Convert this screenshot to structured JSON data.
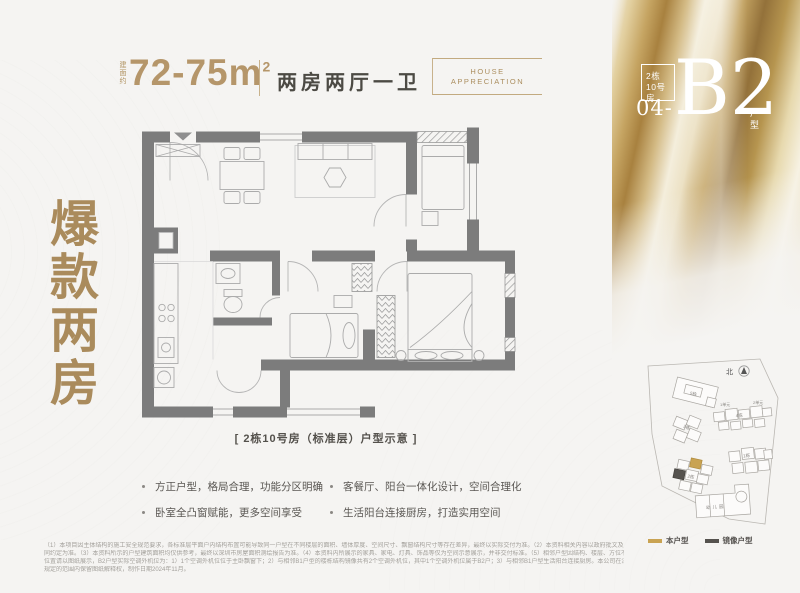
{
  "colors": {
    "page_bg": "#f5f4f2",
    "gold_text": "#aa8b5c",
    "gold_accent": "#c9a352",
    "dark_text": "#4c4a46",
    "wall_gray": "#7c7c7c",
    "mirror_unit": "#55524e"
  },
  "header": {
    "area_label": "建面约",
    "area_value": "72-75m",
    "area_sup": "2",
    "layout_label": "两房两厅一卫",
    "tagline_line1": "HOUSE",
    "tagline_line2": "APPRECIATION"
  },
  "hero_title": "爆款两房",
  "unit_badge": {
    "building": "2栋",
    "room": "10号房",
    "number": "04-",
    "code": "B2",
    "suffix": "户型"
  },
  "floorplan": {
    "caption": "[ 2栋10号房（标准层）户型示意 ]"
  },
  "features": [
    {
      "text": "方正户型，格局合理，功能分区明确"
    },
    {
      "text": "客餐厅、阳台一体化设计，空间合理化"
    },
    {
      "text": "卧室全凸窗赋能，更多空间享受"
    },
    {
      "text": "生活阳台连接厨房，打造实用空间"
    }
  ],
  "siteplan": {
    "north": "北",
    "buildings": [
      "5栋",
      "4栋",
      "3栋",
      "1栋",
      "2栋",
      "幼儿园"
    ],
    "units": [
      "1单元",
      "2单元"
    ],
    "legend": [
      {
        "label": "本户型",
        "color": "#c9a352"
      },
      {
        "label": "镜像户型",
        "color": "#55524e"
      }
    ]
  },
  "disclaimer": {
    "lines": [
      "（1）本项目因主体结构的施工安全规范要求，各标准层平面户内结构布置可能导致同一户型在不同楼层的面积、墙体厚度、空间尺寸、飘窗结构尺寸等存在差异，最终以实际交付为准。（2）本资料相关内容以政府批文及商品房买卖合",
      "同约定为准。（3）本资料所示的户型建筑面积均仅供参考，最终以深圳市房屋面积测绘报告为准。（4）本资料内所展示的家具、家电、灯具、饰品等仅为空间示意展示，并非交付标准。（5）相邻户型因结构、楼层、方位不同而存在差异，",
      "位置请以图纸展示，B2户型实际空调外机位为：1）1个空调外机位位于主卧飘窗下；2）与相邻B1户型的楼栋结构镜像共有2个空调外机位，其中1个空调外机位属于B2户；3）与相邻B1户型生活阳台连接厨房。本公司在法律",
      "规定的范围内保留图纸解释权，制作日期2024年11月。"
    ]
  }
}
